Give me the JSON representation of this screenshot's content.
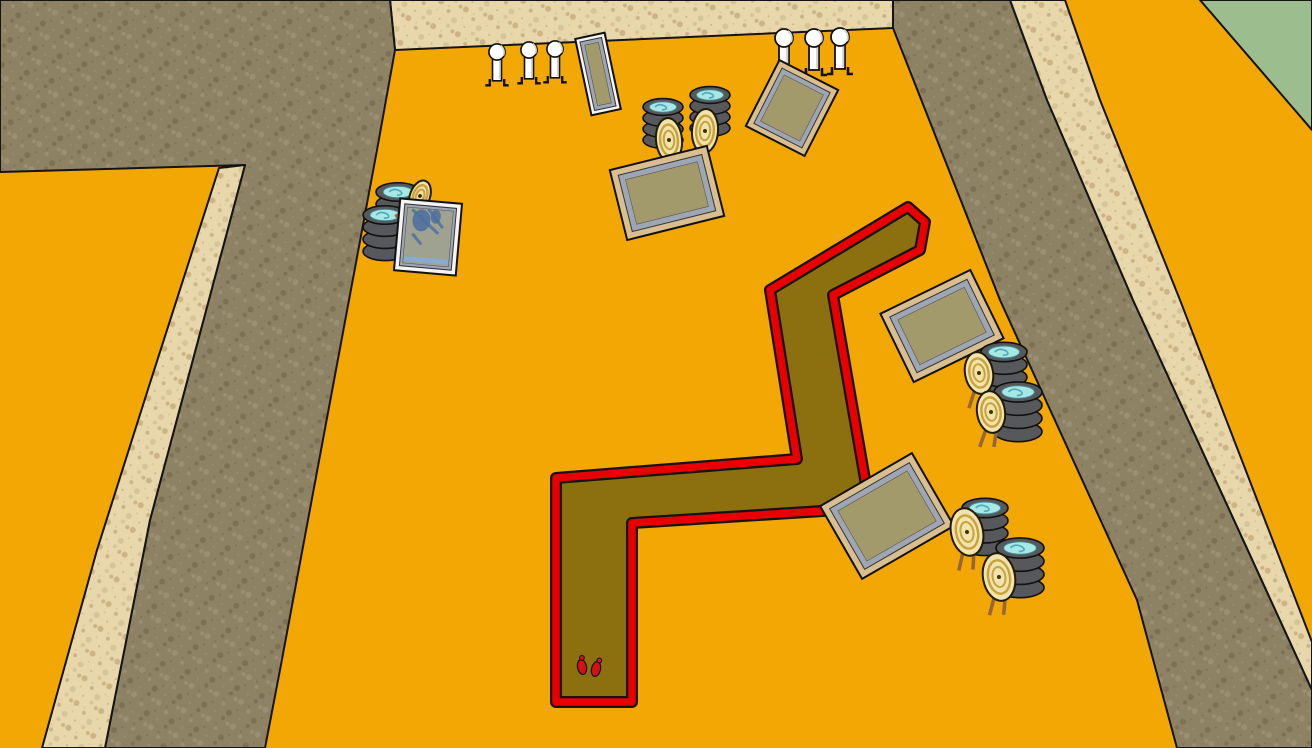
{
  "scene": {
    "title": "shooting-range-3d-scene",
    "colors": {
      "field": "#F2A705",
      "grass": "#9CBD8E",
      "berm_dark_base": "#8E8265",
      "berm_dark_dots": [
        "#776A4E",
        "#A1947A"
      ],
      "berm_light_base": "#E7D7AB",
      "berm_light_dots": [
        "#D2BC8E",
        "#C2A674"
      ],
      "outline": "#141414",
      "course_fill": "#8C7010",
      "course_border": "#E80000",
      "wood_frame": "#D9BE8F",
      "white_frame": "#F4F4F4",
      "panel_bevel": "#9EA6B4",
      "panel_face": "#A39A6B",
      "mirror_face": "#9FA191",
      "mirror_paint": "#4A6FA0",
      "mirror_strip": "#85ACD6",
      "tire_body": "#56585C",
      "tire_water": "#A7E7E4",
      "tire_swirl": "#4FA8BC",
      "target_cream": "#F0E3AE",
      "target_ring": "#C8A23A",
      "target_stick": "#96653A",
      "popper_white": "#FFFFFF",
      "footprint_red": "#D51212"
    },
    "terrain": [
      {
        "name": "back-wall-berm",
        "tex": "light",
        "points": "390,0 893,0 893,28 395,50"
      },
      {
        "name": "left-berm-face",
        "tex": "dark",
        "points": "0,0 390,0 395,50 377,150 280,670 265,748 105,748 150,520 245,165 0,172"
      },
      {
        "name": "left-berm-top-strip",
        "tex": "light",
        "points": "219,168 245,165 150,520 105,748 42,748 97,550 150,383"
      },
      {
        "name": "right-berm-face",
        "tex": "dark",
        "points": "893,0 1010,0 1047,100 1133,300 1312,690 1312,748 1177,748 1137,600 1000,300 893,28"
      },
      {
        "name": "right-berm-top-strip",
        "tex": "light",
        "points": "1010,0 1065,0 1100,100 1180,300 1312,642 1312,690 1133,300 1047,100"
      },
      {
        "name": "grass-corner",
        "tex": "grass",
        "points": "1200,0 1312,0 1312,130"
      }
    ],
    "course": {
      "name": "zigzag-trench-course",
      "outline": "556,702 556,478 797,459 770,290 908,207 925,222 920,250 833,295 870,508 632,523 632,702",
      "feet": [
        {
          "x": 582,
          "y": 667,
          "rot": -10
        },
        {
          "x": 596,
          "y": 669,
          "rot": 12
        }
      ]
    },
    "objects": [
      {
        "type": "panel",
        "name": "silver-frame-panel-top",
        "cx": 598,
        "cy": 74,
        "w": 30,
        "h": 78,
        "rot": -12,
        "frame": "white",
        "ft": 4,
        "bt": 4
      },
      {
        "type": "popper",
        "name": "popper-target",
        "x": 497,
        "y": 52,
        "s": 0.9
      },
      {
        "type": "popper",
        "name": "popper-target",
        "x": 529,
        "y": 50,
        "s": 0.9
      },
      {
        "type": "popper",
        "name": "popper-target",
        "x": 555,
        "y": 49,
        "s": 0.9
      },
      {
        "type": "stack",
        "name": "tire-stack",
        "x": 663,
        "y": 107,
        "rx": 20
      },
      {
        "type": "stack",
        "name": "tire-stack",
        "x": 710,
        "y": 95,
        "rx": 20
      },
      {
        "type": "target",
        "name": "oval-ring-target",
        "x": 669,
        "y": 140,
        "rx": 13,
        "ry": 22,
        "rot": -5
      },
      {
        "type": "target",
        "name": "oval-ring-target",
        "x": 705,
        "y": 131,
        "rx": 13,
        "ry": 22,
        "rot": 4
      },
      {
        "type": "panel",
        "name": "wood-frame-panel-center",
        "cx": 667,
        "cy": 193,
        "w": 100,
        "h": 72,
        "rot": -14,
        "frame": "wood",
        "ft": 7,
        "bt": 6
      },
      {
        "type": "popper",
        "name": "popper-target",
        "x": 784,
        "y": 38,
        "s": 1.0
      },
      {
        "type": "popper",
        "name": "popper-target",
        "x": 814,
        "y": 38,
        "s": 1.0
      },
      {
        "type": "popper",
        "name": "popper-target",
        "x": 840,
        "y": 37,
        "s": 1.0
      },
      {
        "type": "panel",
        "name": "wood-frame-panel-top-right",
        "cx": 792,
        "cy": 108,
        "w": 66,
        "h": 74,
        "rot": 27,
        "frame": "wood",
        "ft": 6,
        "bt": 5
      },
      {
        "type": "stack",
        "name": "tire-stack",
        "x": 398,
        "y": 192,
        "rx": 22
      },
      {
        "type": "stack",
        "name": "tire-stack",
        "x": 385,
        "y": 215,
        "rx": 22
      },
      {
        "type": "target",
        "name": "oval-ring-target",
        "x": 420,
        "y": 196,
        "rx": 10,
        "ry": 16,
        "rot": 20
      },
      {
        "type": "panel",
        "name": "mirror-glass-panel-left",
        "cx": 428,
        "cy": 237,
        "w": 62,
        "h": 72,
        "rot": 5,
        "frame": "white",
        "ft": 5,
        "bt": 3,
        "mirror": true
      },
      {
        "type": "panel",
        "name": "wood-frame-panel-right-mid",
        "cx": 942,
        "cy": 326,
        "w": 100,
        "h": 76,
        "rot": -26,
        "frame": "wood",
        "ft": 7,
        "bt": 6
      },
      {
        "type": "stack",
        "name": "tire-stack",
        "x": 1004,
        "y": 352,
        "rx": 23
      },
      {
        "type": "stack",
        "name": "tire-stack",
        "x": 1018,
        "y": 392,
        "rx": 24
      },
      {
        "type": "target",
        "name": "oval-ring-target",
        "x": 979,
        "y": 373,
        "rx": 14,
        "ry": 21,
        "rot": -10
      },
      {
        "type": "target",
        "name": "oval-ring-target",
        "x": 991,
        "y": 412,
        "rx": 14,
        "ry": 21,
        "rot": -8
      },
      {
        "type": "panel",
        "name": "wood-frame-panel-lower-right",
        "cx": 887,
        "cy": 516,
        "w": 106,
        "h": 84,
        "rot": -30,
        "frame": "wood",
        "ft": 7,
        "bt": 6
      },
      {
        "type": "stack",
        "name": "tire-stack",
        "x": 985,
        "y": 508,
        "rx": 23
      },
      {
        "type": "stack",
        "name": "tire-stack",
        "x": 1020,
        "y": 548,
        "rx": 24
      },
      {
        "type": "target",
        "name": "oval-ring-target",
        "x": 967,
        "y": 532,
        "rx": 16,
        "ry": 24,
        "rot": -12
      },
      {
        "type": "target",
        "name": "oval-ring-target",
        "x": 999,
        "y": 577,
        "rx": 16,
        "ry": 24,
        "rot": -10
      }
    ]
  }
}
